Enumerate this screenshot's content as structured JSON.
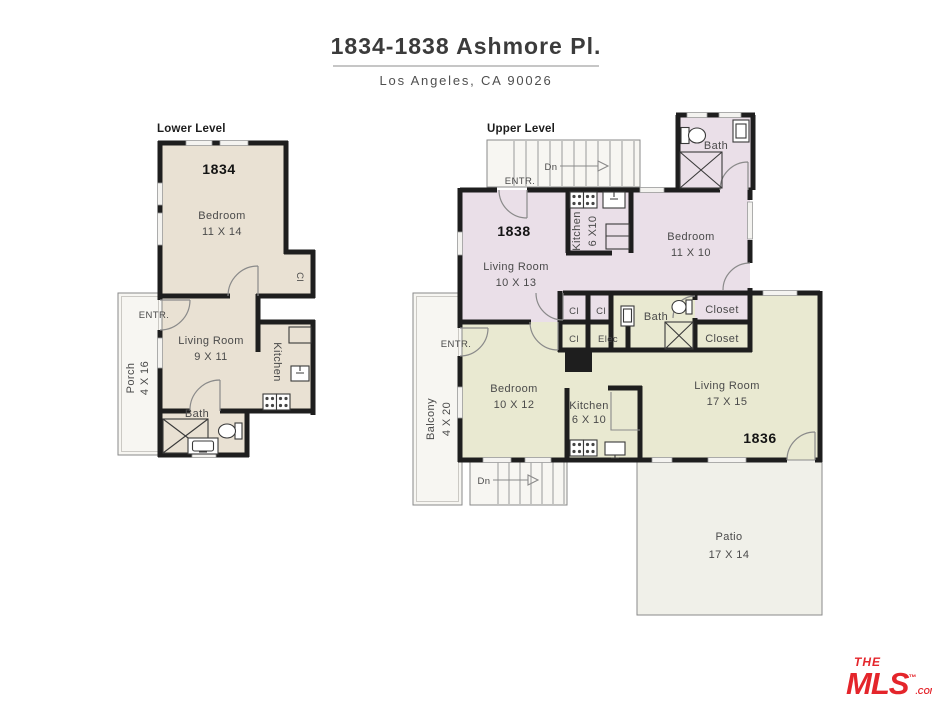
{
  "header": {
    "title": "1834-1838 Ashmore Pl.",
    "subtitle": "Los Angeles, CA 90026"
  },
  "lower_level": {
    "label": "Lower Level",
    "unit": "1834",
    "bedroom": {
      "name": "Bedroom",
      "dims": "11 X 14"
    },
    "living_room": {
      "name": "Living Room",
      "dims": "9 X 11"
    },
    "kitchen": {
      "name": "Kitchen"
    },
    "bath": {
      "name": "Bath"
    },
    "porch": {
      "name": "Porch",
      "dims": "4 X 16"
    },
    "closet": "Cl",
    "entrance": "ENTR."
  },
  "upper_level": {
    "label": "Upper Level",
    "entrance": "ENTR.",
    "stairs_down": "Dn",
    "unit_1838": {
      "number": "1838",
      "living_room": {
        "name": "Living Room",
        "dims": "10 X 13"
      },
      "kitchen": {
        "name": "Kitchen",
        "dims": "6 X10"
      },
      "bedroom": {
        "name": "Bedroom",
        "dims": "11 X 10"
      },
      "bath": "Bath"
    },
    "unit_1836": {
      "number": "1836",
      "living_room": {
        "name": "Living Room",
        "dims": "17 X 15"
      },
      "bedroom": {
        "name": "Bedroom",
        "dims": "10 X 12"
      },
      "kitchen": {
        "name": "Kitchen",
        "dims": "6 X 10"
      },
      "bath": "Bath",
      "balcony": {
        "name": "Balcony",
        "dims": "4 X 20"
      },
      "patio": {
        "name": "Patio",
        "dims": "17 X 14"
      }
    },
    "closets": {
      "cl1": "Cl",
      "cl2": "Cl",
      "cl3": "Cl",
      "elec": "Elec",
      "closet_upper": "Closet",
      "closet_lower": "Closet"
    }
  },
  "logo": {
    "line1": "THE",
    "line2": "MLS",
    "suffix": ".COM",
    "tm": "™"
  },
  "colors": {
    "wall": "#1e1e1e",
    "unit_1834": "#e9e1d3",
    "unit_1838": "#eadfe8",
    "unit_1836": "#e9e9d1",
    "patio": "#f0f0e9",
    "outdoor": "#f7f6f2",
    "logo_red": "#e4252b"
  }
}
